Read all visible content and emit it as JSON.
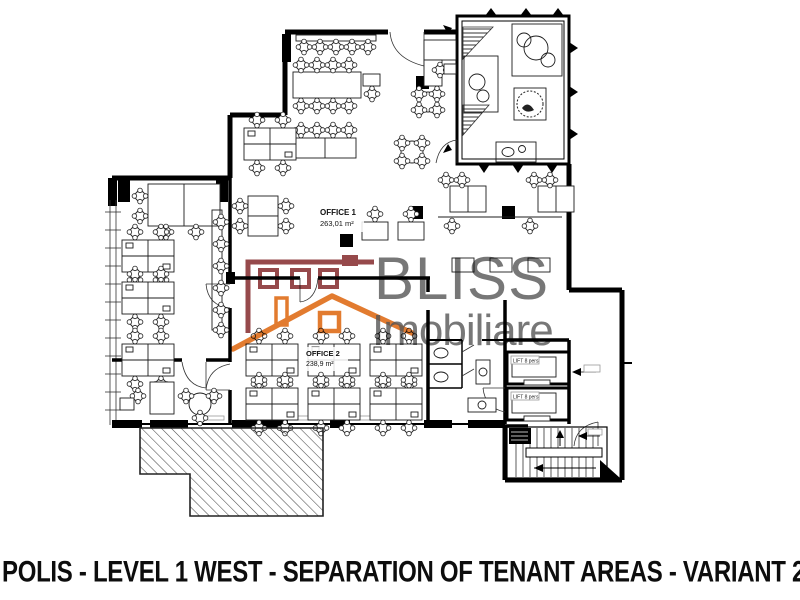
{
  "caption": "POLIS - LEVEL 1 WEST - SEPARATION OF TENANT AREAS - VARIANT 2",
  "watermark": {
    "brand_line1": "BLISS",
    "brand_line2": "Imobiliare",
    "colors": {
      "roof_orange": "#E0701E",
      "house_maroon": "#8E3A3C",
      "text_gray": "#565656"
    }
  },
  "plan": {
    "office1": {
      "name": "OFFICE 1",
      "area": "263,01 m²"
    },
    "office2": {
      "name": "OFFICE 2",
      "area": "238,9 m²"
    },
    "lift1": {
      "label": "LIFT 8 pers"
    },
    "lift2": {
      "label": "LIFT 8 pers"
    }
  }
}
